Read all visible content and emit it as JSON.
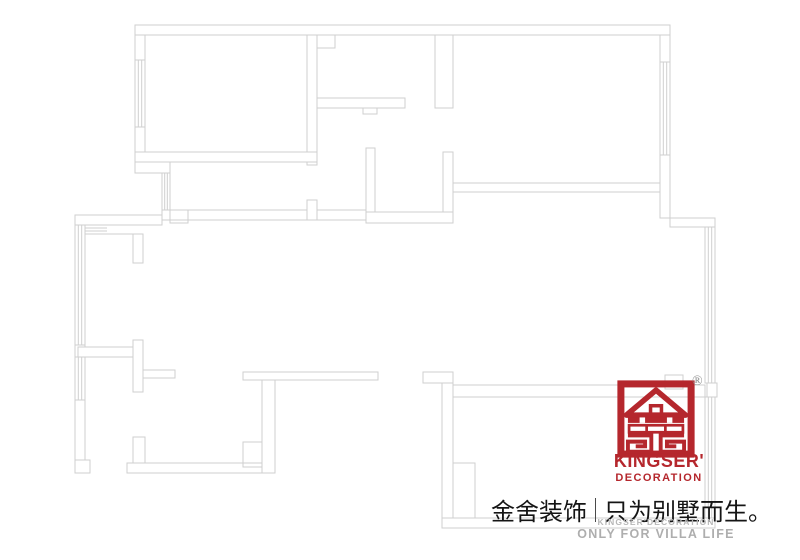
{
  "branding": {
    "registered_mark": "®",
    "name": "KINGSER'",
    "subtitle": "DECORATION",
    "logo_icon": "kingser-house-mark-icon"
  },
  "slogan": {
    "cn_left": "金舍装饰",
    "cn_right": "只为别墅而生。",
    "en_line1": "KINGSER'DECORATION",
    "en_line2": "ONLY FOR VILLA LIFE"
  },
  "colors": {
    "brand_red": "#b5272d",
    "plan_line_gray": "#cfcfcf",
    "slogan_black": "#151515",
    "footer_gray": "#aeaeae"
  },
  "floor_plan": {
    "kind": "residential floor plan line drawing",
    "features": [
      "walls",
      "window hatching",
      "door openings",
      "bay window",
      "shaft boxes"
    ]
  }
}
